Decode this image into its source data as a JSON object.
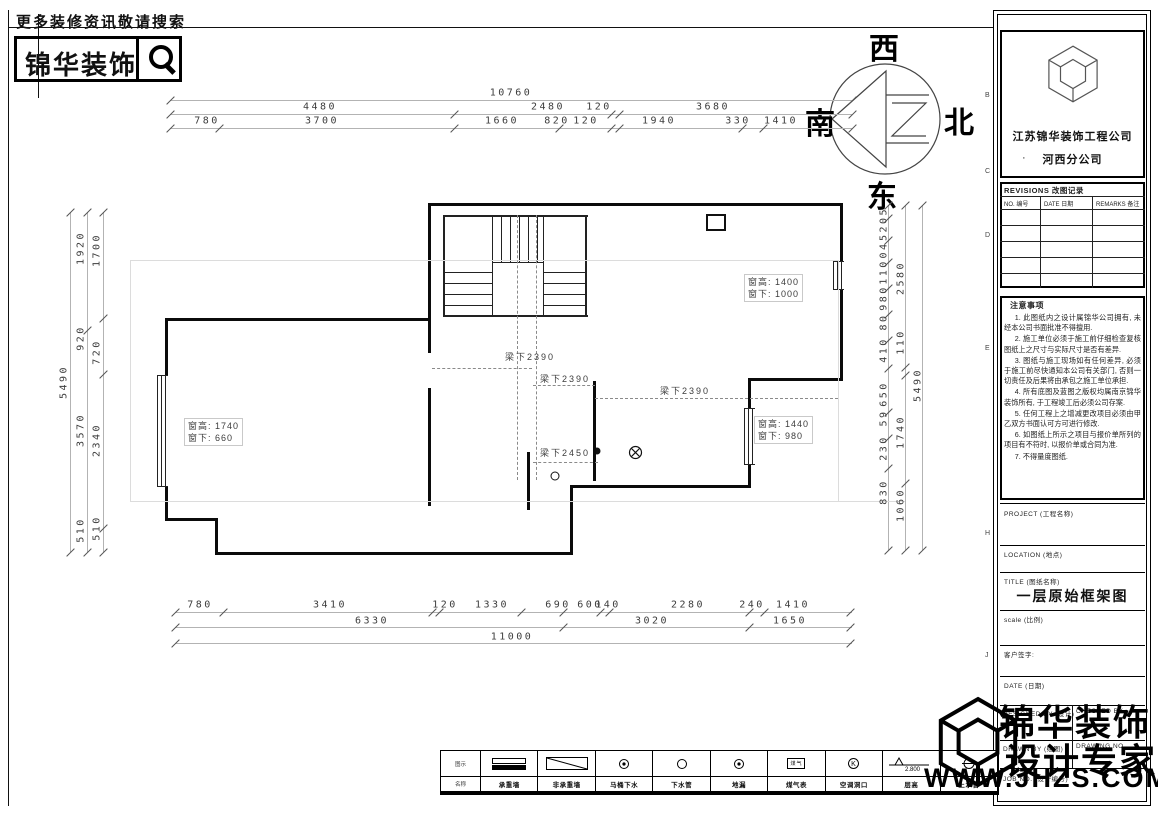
{
  "header": {
    "search_hint": "更多装修资讯敬请搜索",
    "brand": "锦华装饰"
  },
  "compass": {
    "west": "西",
    "north": "北",
    "east": "东",
    "south": "南"
  },
  "dims": {
    "top_row1": [
      "10760"
    ],
    "top_row2": [
      "4480",
      "2480",
      "120",
      "3680"
    ],
    "top_row3": [
      "780",
      "3700",
      "1660",
      "820",
      "120",
      "1940",
      "330",
      "1410"
    ],
    "bottom_row1": [
      "780",
      "3410",
      "120",
      "1330",
      "690",
      "600",
      "140",
      "2280",
      "240",
      "1410"
    ],
    "bottom_row2": [
      "6330",
      "3020",
      "1650"
    ],
    "bottom_row3": [
      "11000"
    ],
    "left": [
      "5490",
      "1920",
      "920",
      "3570",
      "510",
      "1700",
      "720",
      "2340",
      "510"
    ],
    "right": [
      "5205",
      "04",
      "110",
      "980",
      "80",
      "410",
      "650",
      "59",
      "230",
      "830",
      "2580",
      "110",
      "1740",
      "1060",
      "5490"
    ]
  },
  "beams": [
    "梁下2390",
    "梁下2390",
    "梁下2390",
    "梁下2450"
  ],
  "windows": [
    {
      "line1": "窗高: 1400",
      "line2": "窗下: 1000"
    },
    {
      "line1": "窗高: 1740",
      "line2": "窗下: 660"
    },
    {
      "line1": "窗高: 1440",
      "line2": "窗下: 980"
    }
  ],
  "grid_letters": [
    "B",
    "C",
    "D",
    "E",
    "H",
    "J"
  ],
  "titleblock": {
    "company": "江苏锦华装饰工程公司",
    "branch_bullet": "·",
    "branch": "河西分公司",
    "revisions_title": "REVISIONS 改图记录",
    "rev_cols": [
      "NO. 编号",
      "DATE 日期",
      "REMARKS 备注"
    ],
    "notes_title": "注意事项",
    "notes": [
      "1. 此图纸内之设计属锦华公司拥有, 未经本公司书面批准不得擅用.",
      "2. 施工单位必须于施工前仔细检查复核图纸上之尺寸与实际尺寸是否有差异.",
      "3. 图纸与施工现场如有任何差异, 必须于施工前尽快通知本公司有关部门, 否则一切责任及后果将由承包之施工单位承担.",
      "4. 所有底图及蓝图之版权均属南京锦华装饰所有, 于工程竣工后必须公司存案.",
      "5. 任何工程上之增减更改项目必须由甲乙双方书面认可方可进行修改.",
      "6. 如图纸上所示之项目与报价单所列的项目有不符时, 以报价单或合同为准.",
      "7. 不得量度图纸."
    ],
    "project_label": "PROJECT (工程名称)",
    "location_label": "LOCATION (地点)",
    "title_label": "TITLE (图纸名称)",
    "drawing_title": "一层原始框架图",
    "scale_label": "scale  (比例)",
    "client_label": "客户签字:",
    "date_label": "DATE (日期)",
    "designed_label": "DESIGNED BY (设计)",
    "checked_label": "CHECKED BY",
    "drawn_label": "DRAWN BY (绘图)",
    "drawing_no_label": "DRAWING NO.",
    "job_no_label": "JOB NO. (设计编号)"
  },
  "legend": {
    "col0_top": "图示",
    "col0_bottom": "名称",
    "items": [
      {
        "sym": "wall-solid",
        "name": "承重墙"
      },
      {
        "sym": "wall-diag",
        "name": "非承重墙"
      },
      {
        "sym": "circle-dot",
        "name": "马桶下水"
      },
      {
        "sym": "circle",
        "name": "下水管"
      },
      {
        "sym": "circle-dot",
        "name": "地漏"
      },
      {
        "sym": "gas-box",
        "name": "煤气表",
        "box_text": "煤气"
      },
      {
        "sym": "circle-k",
        "name": "空调洞口",
        "k": "K"
      },
      {
        "sym": "elev",
        "name": "层高",
        "value": "2.800"
      },
      {
        "sym": "circle-line",
        "name": "上水管"
      }
    ]
  },
  "watermark": {
    "line1": "锦华装饰",
    "line2": "设计专家",
    "url": "WWW.JHZS.COM"
  }
}
